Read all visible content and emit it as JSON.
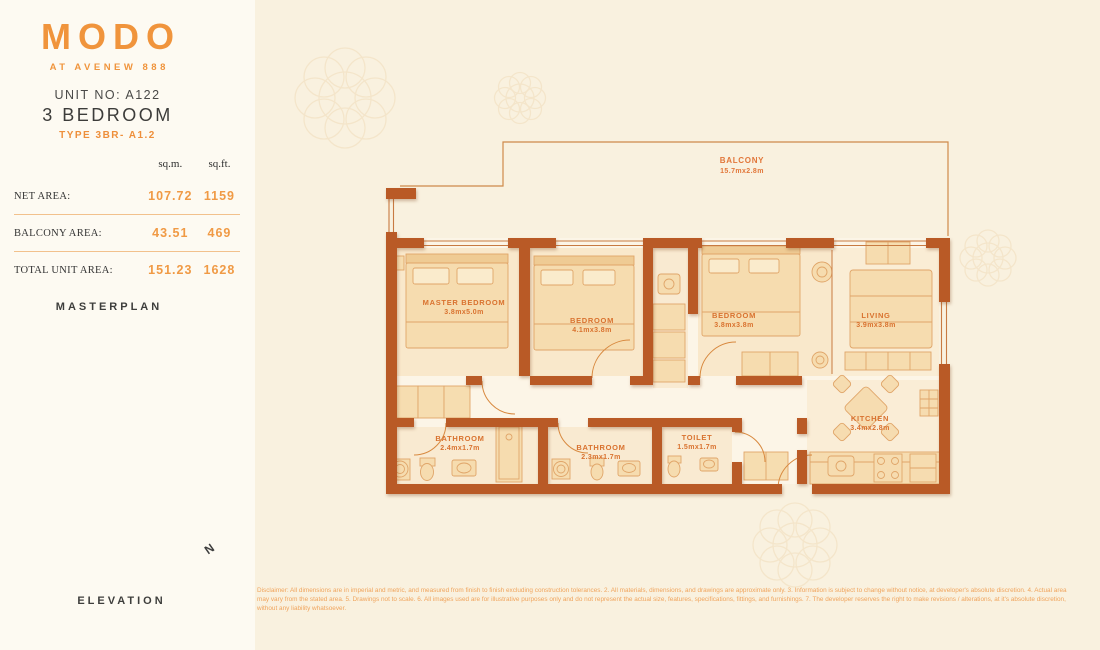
{
  "brand": {
    "logo_text": "MODO",
    "tagline": "AT AVENEW 888"
  },
  "unit": {
    "unit_no_label": "UNIT NO: A122",
    "bedrooms": "3 BEDROOM",
    "type": "TYPE 3BR- A1.2"
  },
  "area_table": {
    "headers": {
      "sqm": "sq.m.",
      "sqft": "sq.ft."
    },
    "rows": [
      {
        "label": "NET AREA:",
        "sqm": "107.72",
        "sqft": "1159"
      },
      {
        "label": "BALCONY AREA:",
        "sqm": "43.51",
        "sqft": "469"
      },
      {
        "label": "TOTAL UNIT AREA:",
        "sqm": "151.23",
        "sqft": "1628"
      }
    ]
  },
  "sections": {
    "masterplan_title": "MASTERPLAN",
    "elevation_title": "ELEVATION"
  },
  "compass": {
    "north_label": "N"
  },
  "floorplan": {
    "balcony": {
      "name": "BALCONY",
      "dims": "15.7mx2.8m"
    },
    "master_bedroom": {
      "name": "MASTER BEDROOM",
      "dims": "3.8mx5.0m"
    },
    "bedroom_2": {
      "name": "BEDROOM",
      "dims": "4.1mx3.8m"
    },
    "bedroom_3": {
      "name": "BEDROOM",
      "dims": "3.8mx3.8m"
    },
    "living": {
      "name": "LIVING",
      "dims": "3.9mx3.8m"
    },
    "bathroom_1": {
      "name": "BATHROOM",
      "dims": "2.4mx1.7m"
    },
    "bathroom_2": {
      "name": "BATHROOM",
      "dims": "2.3mx1.7m"
    },
    "toilet": {
      "name": "TOILET",
      "dims": "1.5mx1.7m"
    },
    "kitchen": {
      "name": "KITCHEN",
      "dims": "3.4mx2.8m"
    }
  },
  "colors": {
    "brand_orange": "#f0943c",
    "wall_orange": "#b95a26",
    "label_orange": "#d9722f",
    "text_dark": "#3c3c3a"
  },
  "disclaimer": "Disclaimer: All dimensions are in imperial and metric, and measured from finish to finish excluding construction tolerances. 2. All materials, dimensions, and drawings are approximate only. 3. Information is subject to change without notice, at developer's absolute discretion. 4. Actual area may vary from the stated area. 5. Drawings not to scale. 6. All images used are for illustrative purposes only and do not represent the actual size, features, specifications, fittings, and furnishings. 7. The developer reserves the right to make revisions / alterations, at it's absolute discretion, without any liability whatsoever."
}
